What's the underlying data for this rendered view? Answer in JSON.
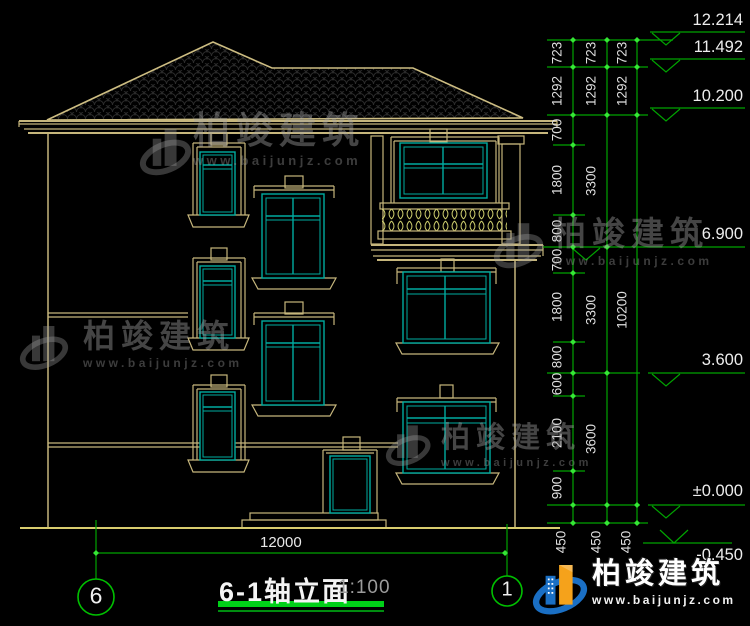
{
  "title_block": {
    "name": "6-1轴立面",
    "scale": "1:100"
  },
  "axis_bubbles": {
    "left": "6",
    "right": "1"
  },
  "ground_dimension": "12000",
  "levels": {
    "top": "12.214",
    "ridge": "11.492",
    "eave": "10.200",
    "floor3": "6.900",
    "floor2": "3.600",
    "zero": "±0.000",
    "grade": "-0.450"
  },
  "dim_col1": [
    "723",
    "1292",
    "700",
    "1800",
    "800",
    "700",
    "1800",
    "800",
    "600",
    "2100",
    "900",
    "450"
  ],
  "dim_col2": [
    "723",
    "1292",
    "3300",
    "3300",
    "3600",
    "450"
  ],
  "dim_col3": [
    "723",
    "1292",
    "10200",
    "450"
  ],
  "watermark": {
    "brand": "柏竣建筑",
    "url": "www.baijunjz.com"
  },
  "colors": {
    "line_green": "#00a400",
    "tick_green": "#35e635",
    "building_tan": "#c6b67c",
    "window_teal": "#00aba0",
    "baluster_yellow": "#cfcf6e",
    "logo_blue": "#1a6fc4",
    "logo_orange": "#f5a21b"
  }
}
